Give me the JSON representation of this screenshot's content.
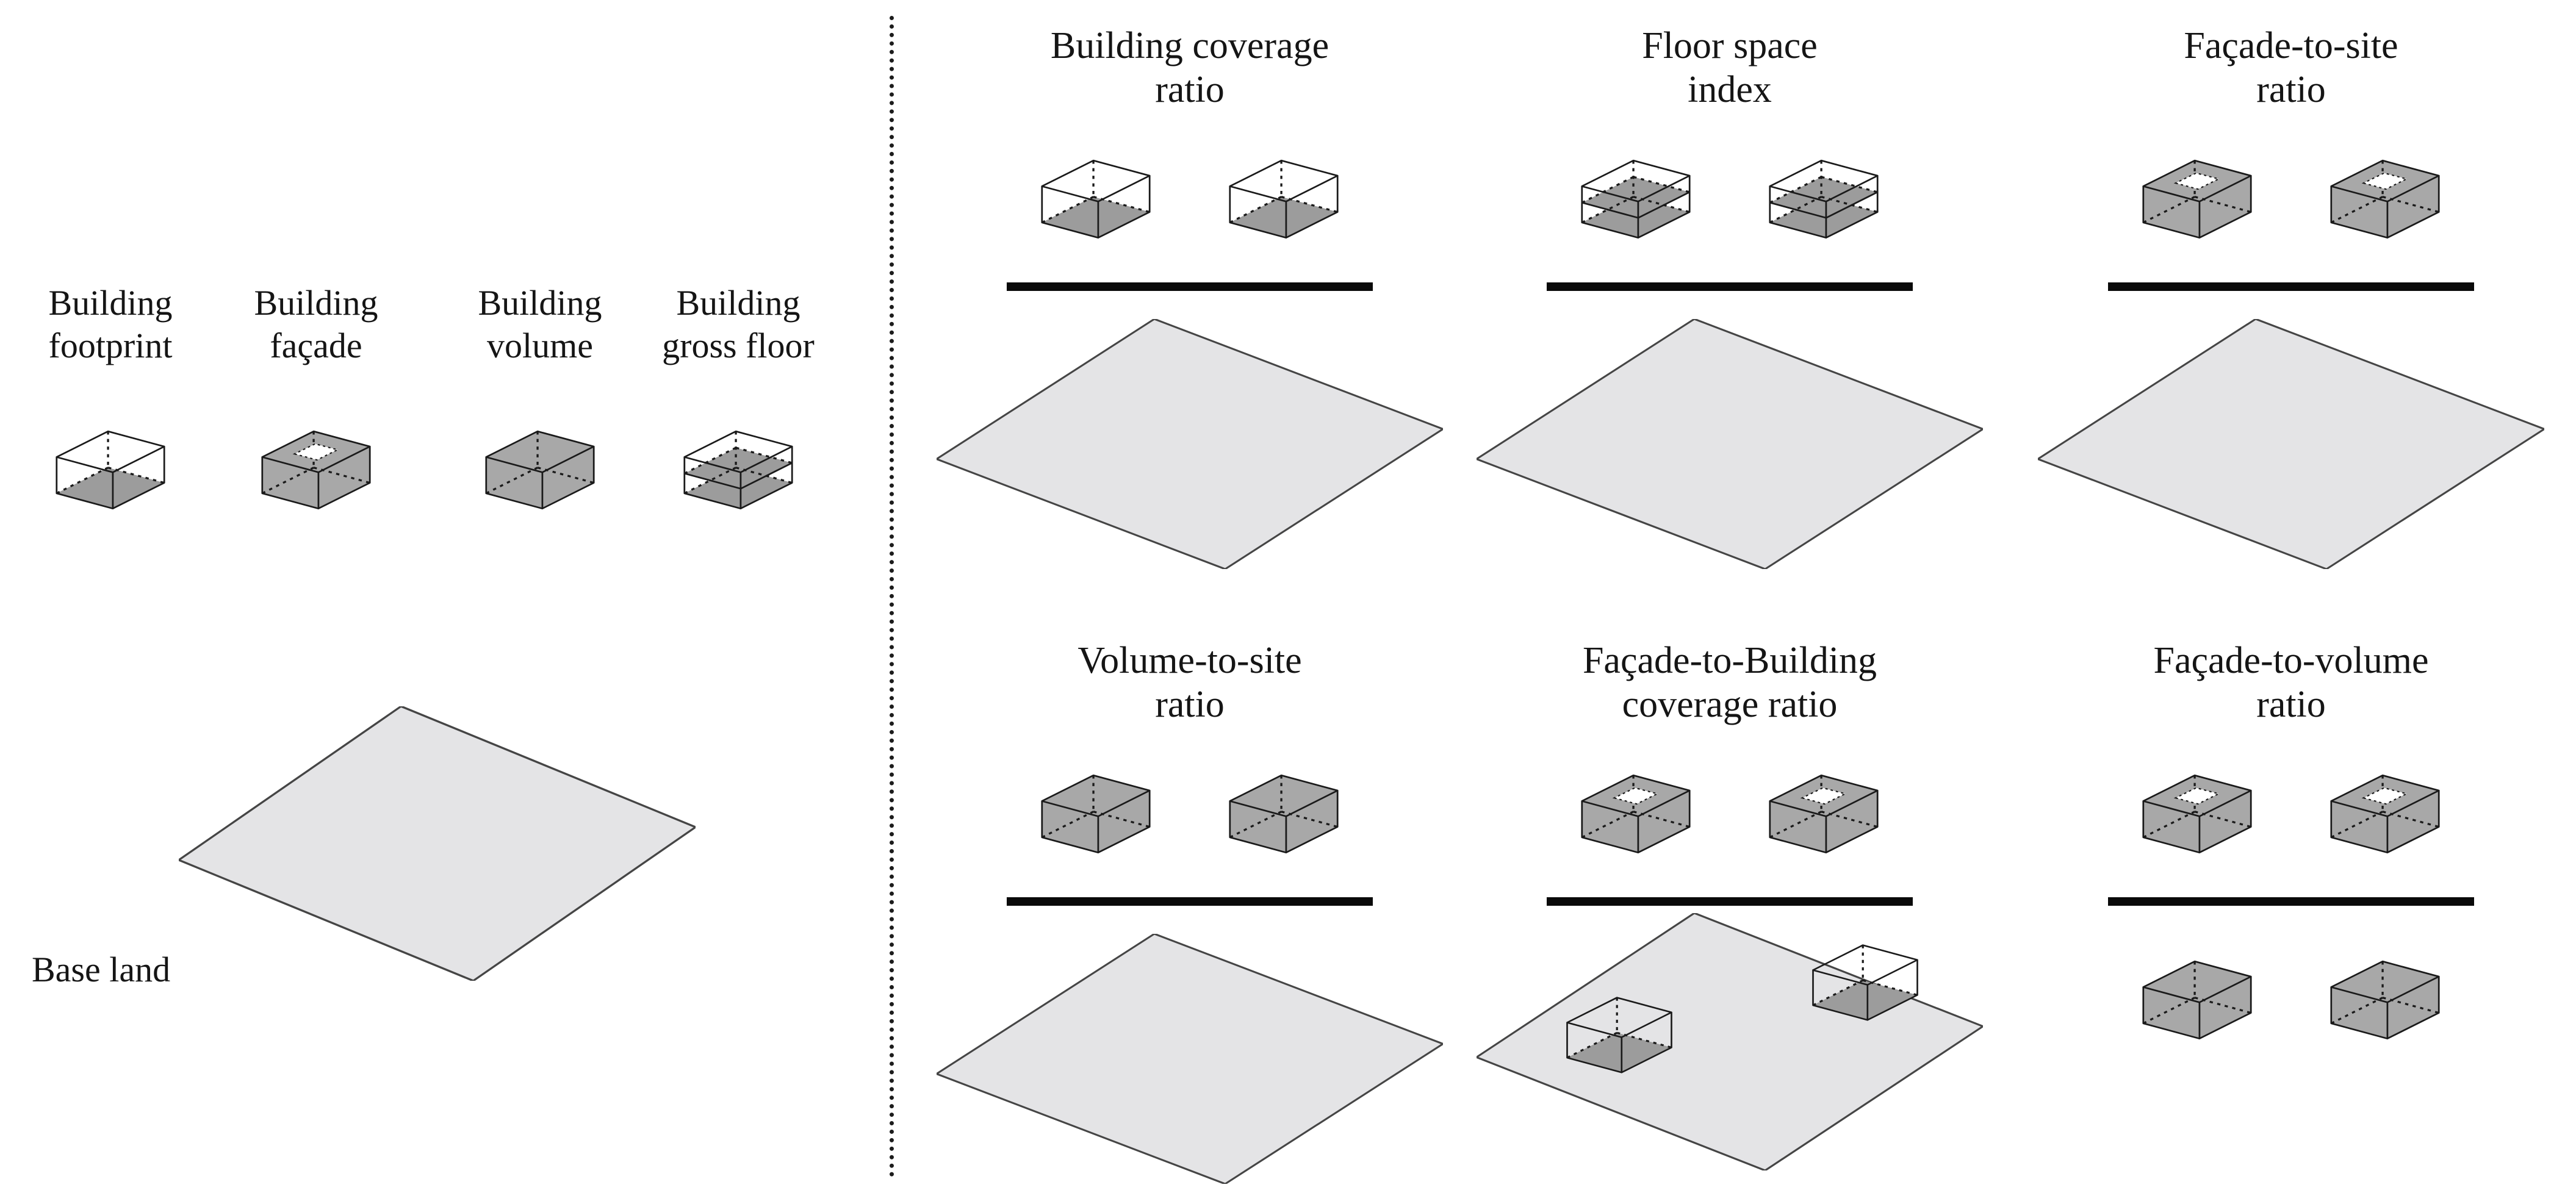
{
  "left": {
    "concepts": [
      {
        "line1": "Building",
        "line2": "footprint",
        "type": "footprint"
      },
      {
        "line1": "Building",
        "line2": "façade",
        "type": "facade"
      },
      {
        "line1": "Building",
        "line2": "volume",
        "type": "volume"
      },
      {
        "line1": "Building",
        "line2": "gross floor",
        "type": "grossfloor"
      }
    ],
    "base_land_label": "Base land"
  },
  "panels": [
    {
      "line1": "Building coverage",
      "line2": "ratio",
      "numerator": "footprint",
      "denominator": "site"
    },
    {
      "line1": "Floor space",
      "line2": "index",
      "numerator": "grossfloor",
      "denominator": "site"
    },
    {
      "line1": "Façade-to-site",
      "line2": "ratio",
      "numerator": "facade",
      "denominator": "site"
    },
    {
      "line1": "Volume-to-site",
      "line2": "ratio",
      "numerator": "volume",
      "denominator": "site"
    },
    {
      "line1": "Façade-to-Building",
      "line2": "coverage ratio",
      "numerator": "facade",
      "denominator": "site-with-footprints"
    },
    {
      "line1": "Façade-to-volume",
      "line2": "ratio",
      "numerator": "facade",
      "denominator": "volume-pair"
    }
  ],
  "colors": {
    "box_gray": "#a8a8a8",
    "floor_gray": "#9c9c9c",
    "land_fill": "#e4e4e6",
    "land_stroke": "#454545",
    "stroke": "#1a1a1a",
    "bar": "#0a0a0a",
    "background": "#ffffff"
  }
}
